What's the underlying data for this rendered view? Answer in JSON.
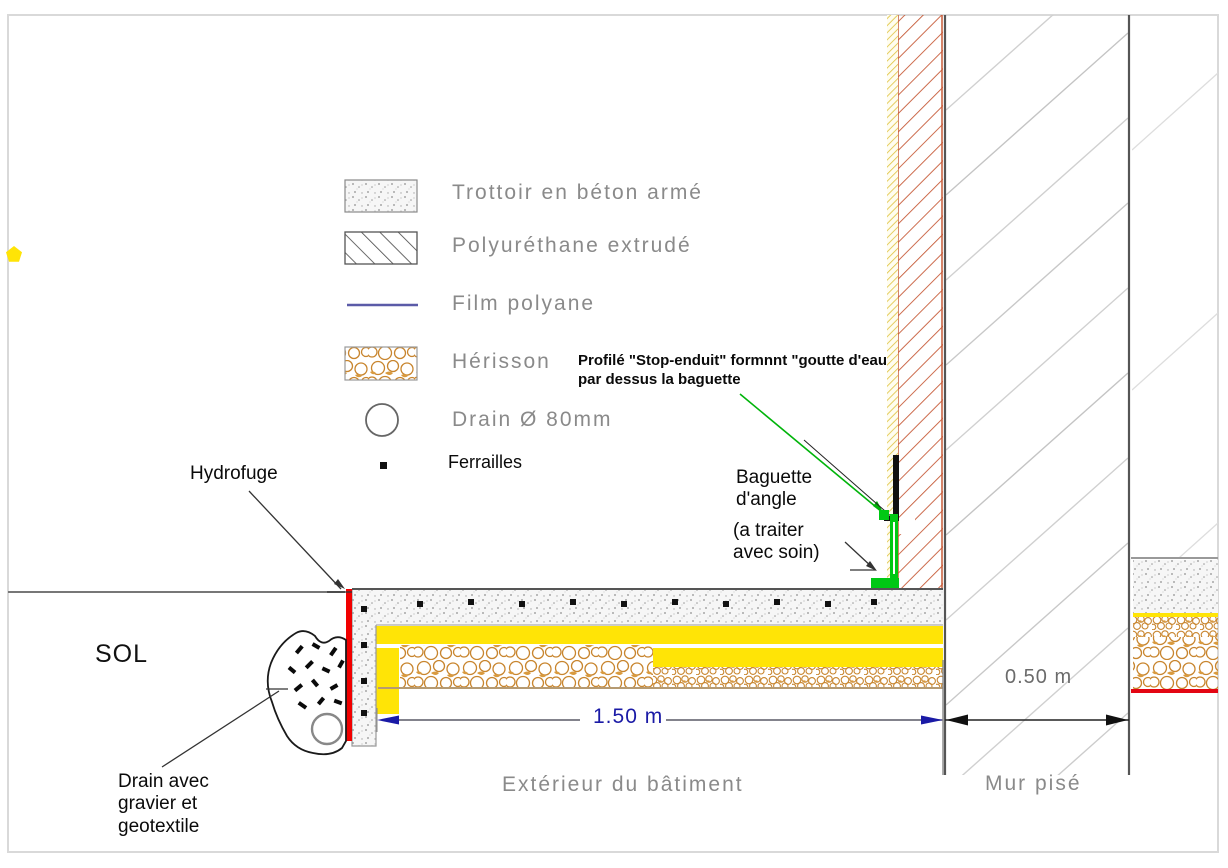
{
  "title": "Coupe technique - pied de mur pisé (détail trottoir / drainage)",
  "legend": {
    "items": [
      {
        "label": "Trottoir en béton armé",
        "swatch": "stipple-concrete"
      },
      {
        "label": "Polyuréthane extrudé",
        "swatch": "diagonal-hatch"
      },
      {
        "label": "Film polyane",
        "swatch": "blue-line"
      },
      {
        "label": "Hérisson",
        "swatch": "stone-pattern"
      },
      {
        "label": "Drain Ø 80mm",
        "swatch": "circle"
      },
      {
        "label": "Ferrailles",
        "swatch": "black-square"
      }
    ]
  },
  "annotations": {
    "profil_stop_enduit": "Profilé \"Stop-enduit\" formnnt \"goutte d'eau\npar dessus la baguette",
    "baguette": "Baguette\nd'angle",
    "baguette_note": "(a traiter\navec soin)",
    "hydrofuge": "Hydrofuge",
    "sol": "SOL",
    "drain_note": "Drain avec\ngravier et\ngeotextile",
    "exterieur": "Extérieur du bâtiment",
    "mur_pise": "Mur pisé"
  },
  "dimensions": {
    "trottoir_width": "1.50 m",
    "mur_width": "0.50 m"
  },
  "colors": {
    "hydrofuge_red": "#f10000",
    "insulation_yellow": "#ffe406",
    "baguette_green": "#00c814",
    "dimension_navy": "#1a1aa6",
    "herisson_orange": "#c8852e",
    "wall_hatch_orange": "#c75b39",
    "cad_text_gray": "#8a8a8a"
  }
}
